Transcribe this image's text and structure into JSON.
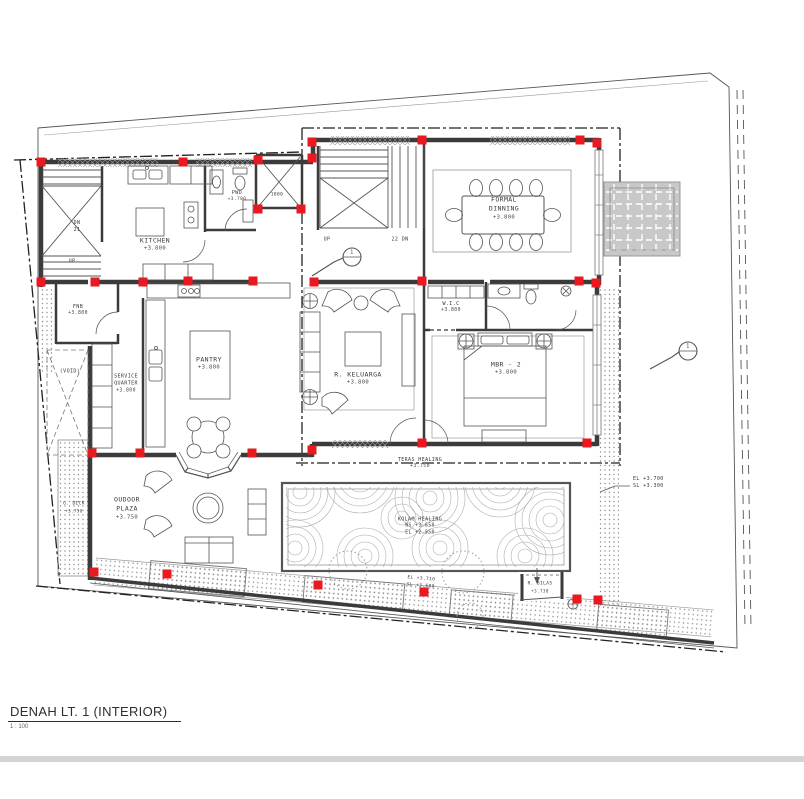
{
  "sheet": {
    "title": "DENAH LT. 1 (INTERIOR)",
    "scale": "1 : 100"
  },
  "colors": {
    "wall": "#3b3b3b",
    "column_red": "#e8191f",
    "line": "#555555",
    "light_line": "#9a9a9a",
    "hatch_fill": "#c8c8c8",
    "band": "#d4d4d4"
  },
  "rooms": {
    "kitchen": {
      "name": "KITCHEN",
      "elev": "+3.800"
    },
    "pwd": {
      "name": "PWD",
      "elev": "+3.780"
    },
    "fnb": {
      "name": "FNB",
      "elev": "+3.800"
    },
    "void": {
      "name": "(VOID)"
    },
    "service": {
      "line1": "SERVICE",
      "line2": "QUARTER",
      "elev": "+3.800"
    },
    "pantry": {
      "name": "PANTRY",
      "elev": "+3.800"
    },
    "keluarga": {
      "name": "R. KELUARGA",
      "elev": "+3.800"
    },
    "wic": {
      "name": "W.I.C",
      "elev": "+3.800"
    },
    "mbr2": {
      "name": "MBR - 2",
      "elev": "+3.800"
    },
    "formal_dinning": {
      "line1": "FORMAL",
      "line2": "DINNING",
      "elev": "+3.800"
    },
    "outdoor_plaza": {
      "line1": "OUDOOR",
      "line2": "PLAZA",
      "elev": "+3.750"
    },
    "gdeck": {
      "name": "G. DECK",
      "elev": "+3.750"
    },
    "teras": {
      "name": "TERAS HEALING",
      "elev": "+3.750"
    },
    "kolam": {
      "name": "KOLAM HEALING",
      "ws": "WS +3.650",
      "el": "EL +2.950"
    },
    "bilas": {
      "name": "R. BILAS",
      "elev": "+3.730"
    }
  },
  "stairs": {
    "left_dn": "DN",
    "left_dn_count": "21",
    "left_up": "UP",
    "main_up": "UP",
    "main_dn": "22 DN"
  },
  "dims": {
    "shaft": "1800"
  },
  "levels": {
    "right_el": "EL +3.700",
    "right_sl": "SL +3.300",
    "deck_el": "EL +3.710",
    "deck_sl": "SL +3.600"
  },
  "markers": {
    "section_1": "1",
    "section_2": "1"
  }
}
